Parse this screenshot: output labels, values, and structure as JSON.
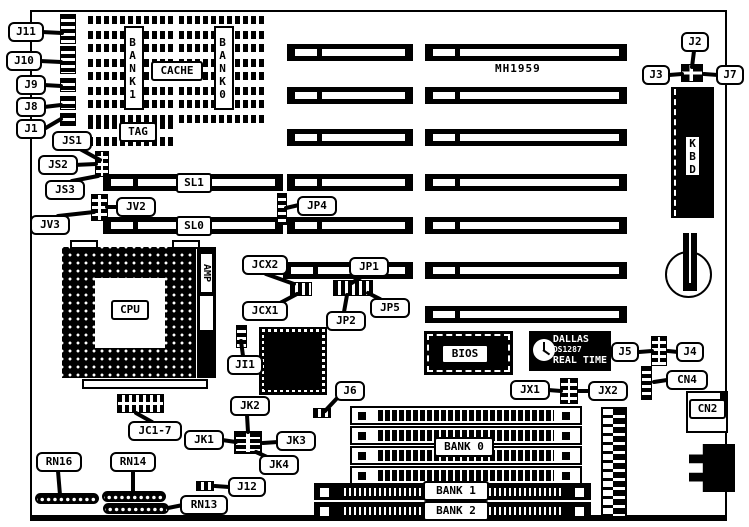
{
  "board": {
    "model": "MH1959"
  },
  "cache": {
    "bank1": "BANK1",
    "bank0": "BANK0",
    "cache": "CACHE",
    "tag": "TAG"
  },
  "cpu": {
    "label": "CPU",
    "socket_brand": "AMP"
  },
  "chips": {
    "bios": "BIOS",
    "kbd": "KBD",
    "rtc_brand": "DALLAS",
    "rtc_part": "DS1287",
    "rtc_type": "REAL TIME"
  },
  "memory": {
    "bank0": "BANK 0",
    "bank1": "BANK 1",
    "bank2": "BANK 2"
  },
  "slots": {
    "sl1": "SL1",
    "sl0": "SL0"
  },
  "callouts": {
    "j11": "J11",
    "j10": "J10",
    "j9": "J9",
    "j8": "J8",
    "j1": "J1",
    "js1": "JS1",
    "js2": "JS2",
    "js3": "JS3",
    "jv2": "JV2",
    "jv3": "JV3",
    "jp4": "JP4",
    "jcx2": "JCX2",
    "jcx1": "JCX1",
    "jp1": "JP1",
    "jp2": "JP2",
    "jp5": "JP5",
    "ji1": "JI1",
    "jk1": "JK1",
    "jk2": "JK2",
    "jk3": "JK3",
    "jk4": "JK4",
    "j6": "J6",
    "jc17": "JC1-7",
    "j12": "J12",
    "rn16": "RN16",
    "rn14": "RN14",
    "rn13": "RN13",
    "j5": "J5",
    "j4": "J4",
    "cn4": "CN4",
    "cn2": "CN2",
    "jx1": "JX1",
    "jx2": "JX2",
    "j2": "J2",
    "j3": "J3",
    "j7": "J7"
  }
}
